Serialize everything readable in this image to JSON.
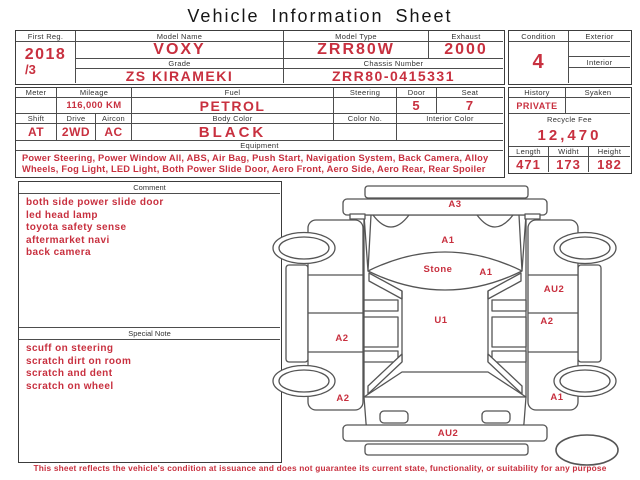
{
  "title": "Vehicle Information Sheet",
  "colors": {
    "accent_red": "#c8303f",
    "line_dark": "#3c3c3c",
    "line_mid": "#4d4d4d",
    "label_text": "#333333"
  },
  "registration": {
    "first_reg": {
      "label": "First Reg.",
      "year": "2018",
      "month": "/3"
    },
    "model_name": {
      "label": "Model Name",
      "value": "VOXY"
    },
    "model_type": {
      "label": "Model Type",
      "value": "ZRR80W"
    },
    "exhaust": {
      "label": "Exhaust",
      "value": "2000"
    },
    "grade": {
      "label": "Grade",
      "value": "ZS KIRAMEKI"
    },
    "chassis_number": {
      "label": "Chassis Number",
      "value": "ZRR80-0415331"
    }
  },
  "condition_box": {
    "condition": {
      "label": "Condition",
      "value": "4"
    },
    "exterior": {
      "label": "Exterior",
      "value": ""
    },
    "interior": {
      "label": "Interior",
      "value": ""
    }
  },
  "spec": {
    "meter": {
      "label": "Meter",
      "value": ""
    },
    "mileage": {
      "label": "Mileage",
      "value": "116,000 KM"
    },
    "fuel": {
      "label": "Fuel",
      "value": "PETROL"
    },
    "steering": {
      "label": "Steering",
      "value": ""
    },
    "door": {
      "label": "Door",
      "value": "5"
    },
    "seat": {
      "label": "Seat",
      "value": "7"
    },
    "shift": {
      "label": "Shift",
      "value": "AT"
    },
    "drive": {
      "label": "Drive",
      "value": "2WD"
    },
    "aircon": {
      "label": "Aircon",
      "value": "AC"
    },
    "body_color": {
      "label": "Body Color",
      "value": "BLACK"
    },
    "color_no": {
      "label": "Color No.",
      "value": ""
    },
    "interior_color": {
      "label": "Interior Color",
      "value": ""
    },
    "equipment": {
      "label": "Equipment",
      "value": "Power Steering, Power Window All, ABS, Air Bag, Push Start, Navigation System, Back Camera, Alloy Wheels, Fog Light, LED Light, Both Power Slide Door, Aero Front, Aero Side, Aero Rear, Rear Spoiler"
    }
  },
  "history_box": {
    "history": {
      "label": "History",
      "value": "PRIVATE"
    },
    "syaken": {
      "label": "Syaken",
      "value": ""
    },
    "recycle_fee": {
      "label": "Recycle Fee",
      "value": "12,470"
    },
    "length": {
      "label": "Length",
      "value": "471"
    },
    "width": {
      "label": "Widht",
      "value": "173"
    },
    "height": {
      "label": "Height",
      "value": "182"
    }
  },
  "comment": {
    "label": "Comment",
    "items": [
      "both side power slide door",
      "led head lamp",
      "toyota safety sense",
      "aftermarket navi",
      "back camera"
    ]
  },
  "special_note": {
    "label": "Special Note",
    "items": [
      "scuff on steering",
      "scratch dirt on room",
      "scratch and dent",
      "scratch on wheel"
    ]
  },
  "diagram": {
    "labels": [
      {
        "text": "A3",
        "x": 185,
        "y": 24
      },
      {
        "text": "A1",
        "x": 178,
        "y": 60
      },
      {
        "text": "Stone",
        "x": 168,
        "y": 89
      },
      {
        "text": "A1",
        "x": 216,
        "y": 92
      },
      {
        "text": "AU2",
        "x": 284,
        "y": 109
      },
      {
        "text": "U1",
        "x": 171,
        "y": 140
      },
      {
        "text": "A2",
        "x": 277,
        "y": 141
      },
      {
        "text": "A2",
        "x": 72,
        "y": 158
      },
      {
        "text": "A2",
        "x": 73,
        "y": 218
      },
      {
        "text": "A1",
        "x": 287,
        "y": 217
      },
      {
        "text": "AU2",
        "x": 178,
        "y": 253
      }
    ]
  },
  "disclaimer": "This sheet reflects the vehicle's condition at issuance and does not guarantee its current state, functionality, or suitability for any purpose"
}
